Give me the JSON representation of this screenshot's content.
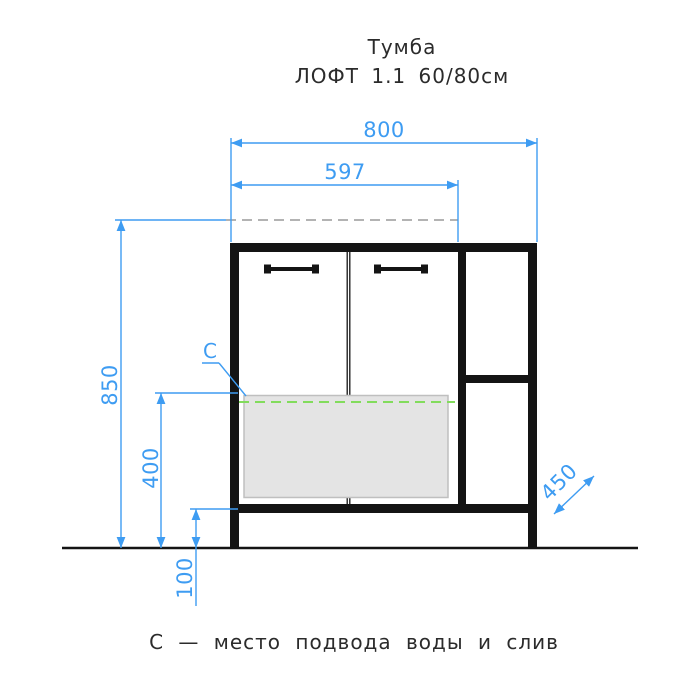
{
  "title": {
    "line1": "Тумба",
    "line2": "ЛОФТ 1.1  60/80см"
  },
  "caption": "С — место подвода воды и слив",
  "dimensions": {
    "outer_width": "800",
    "basin_width": "597",
    "total_height": "850",
    "connection_height": "400",
    "plinth_height": "100",
    "depth": "450",
    "connection_mark": "C"
  },
  "colors": {
    "dimension": "#3e9cf2",
    "connection": "#82dc5c",
    "hidden": "#b3b3b3",
    "drawing": "#141414",
    "sink_fill": "#e4e4e4",
    "sink_border": "#bfbfbf",
    "text": "#2b2b2b",
    "background": "#ffffff"
  }
}
